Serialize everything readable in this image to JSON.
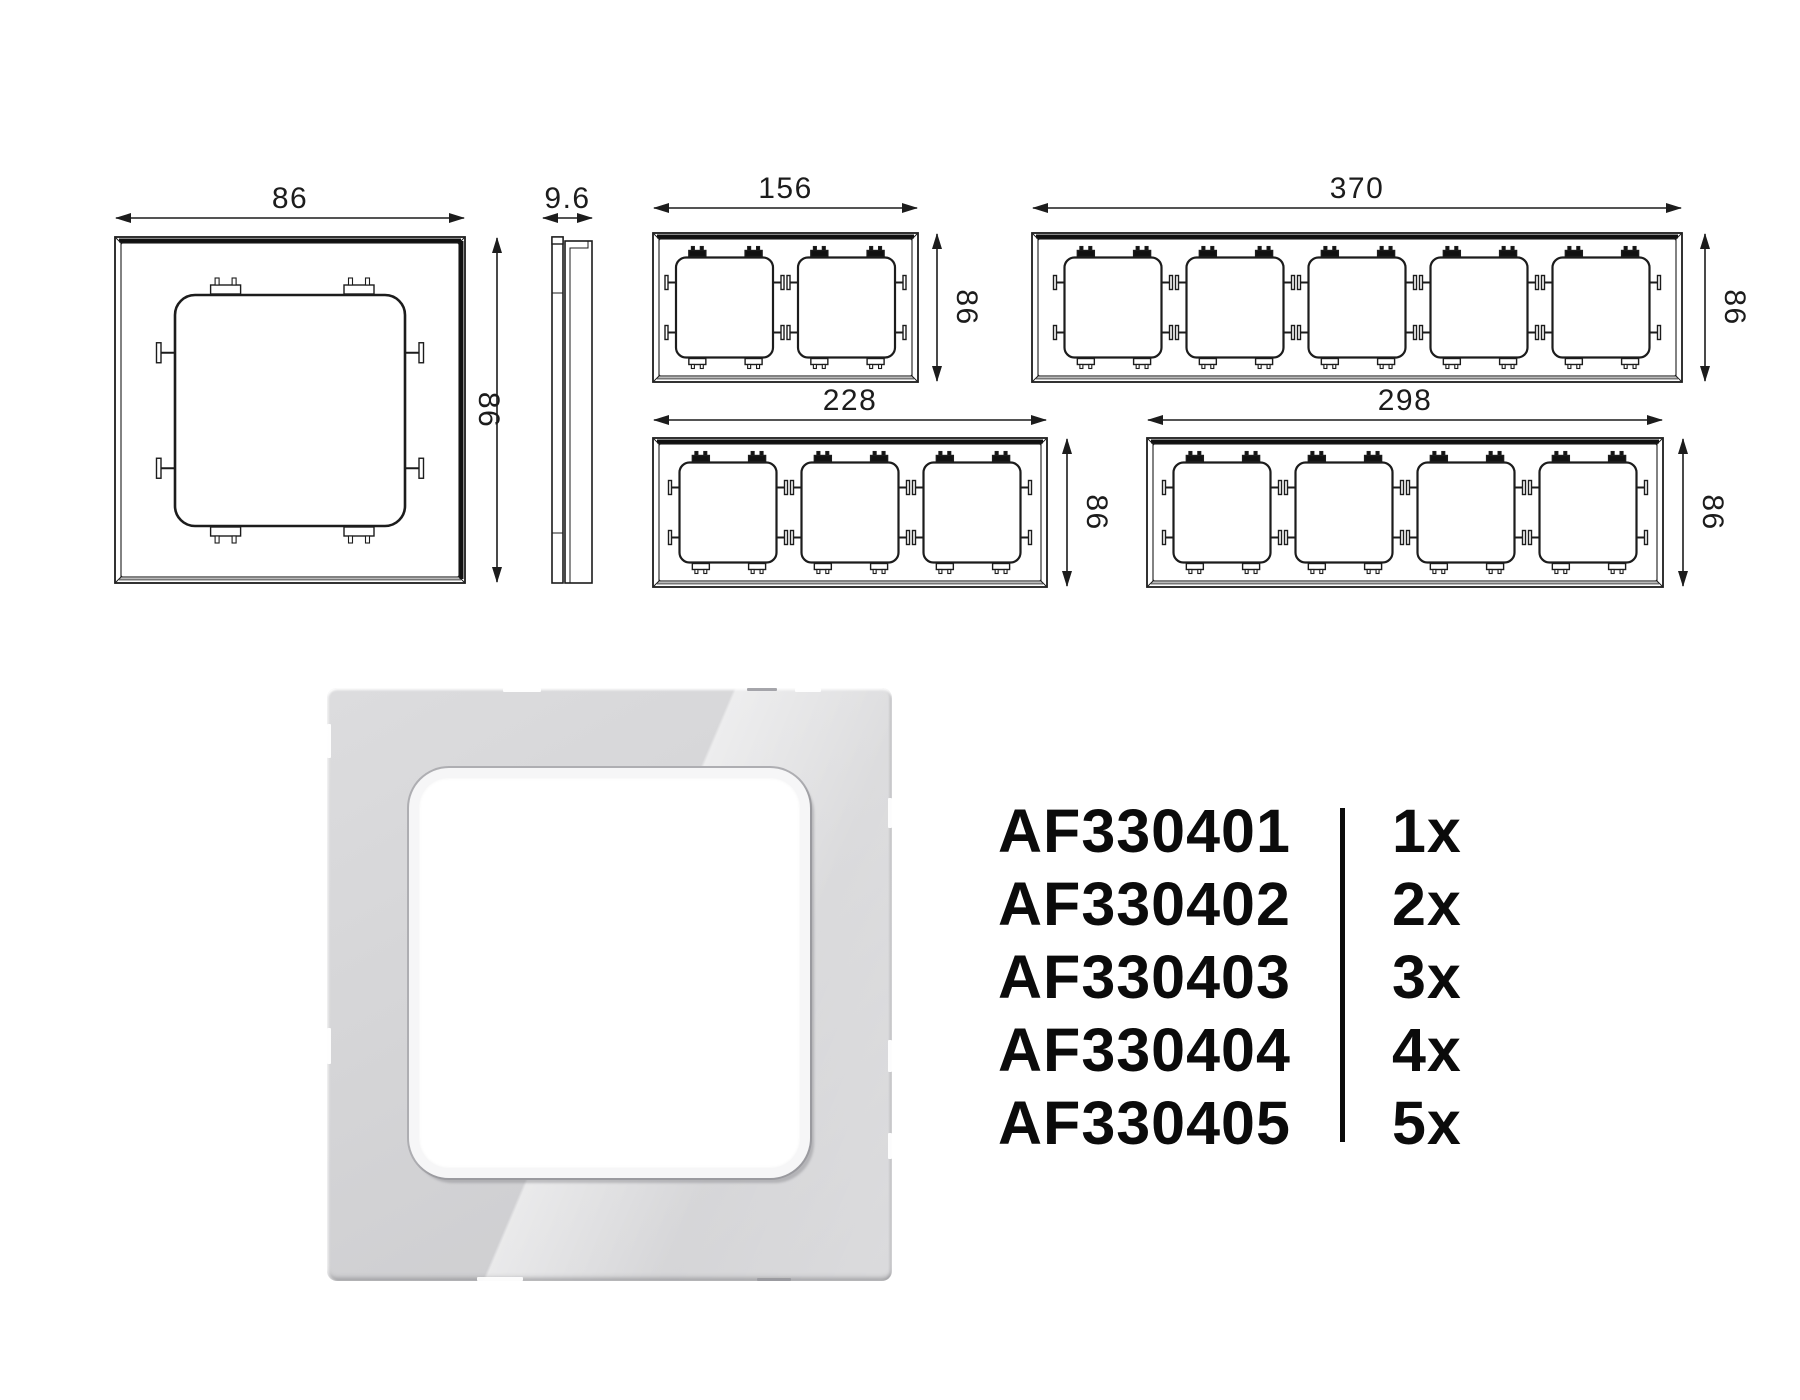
{
  "colors": {
    "line": "#1c1c1c",
    "text": "#0b0b0b",
    "plate_base": "#d2d2d4",
    "background": "#ffffff"
  },
  "technical_drawings": {
    "front_views": [
      {
        "id": "1g",
        "name": "frame-1-gang-drawing",
        "gangs": 1,
        "top_dim": "86",
        "side_dim": "86"
      },
      {
        "id": "2g",
        "name": "frame-2-gang-drawing",
        "gangs": 2,
        "top_dim": "156",
        "side_dim": "86"
      },
      {
        "id": "5g",
        "name": "frame-5-gang-drawing",
        "gangs": 5,
        "top_dim": "370",
        "side_dim": "86"
      },
      {
        "id": "3g",
        "name": "frame-3-gang-drawing",
        "gangs": 3,
        "top_dim": "228",
        "side_dim": "86"
      },
      {
        "id": "4g",
        "name": "frame-4-gang-drawing",
        "gangs": 4,
        "top_dim": "298",
        "side_dim": "86"
      }
    ],
    "profile_view": {
      "id": "side",
      "name": "frame-side-profile-drawing",
      "top_dim": "9.6"
    }
  },
  "parts_list": {
    "rows": [
      {
        "code": "AF330401",
        "qty": "1x"
      },
      {
        "code": "AF330402",
        "qty": "2x"
      },
      {
        "code": "AF330403",
        "qty": "3x"
      },
      {
        "code": "AF330404",
        "qty": "4x"
      },
      {
        "code": "AF330405",
        "qty": "5x"
      }
    ]
  }
}
